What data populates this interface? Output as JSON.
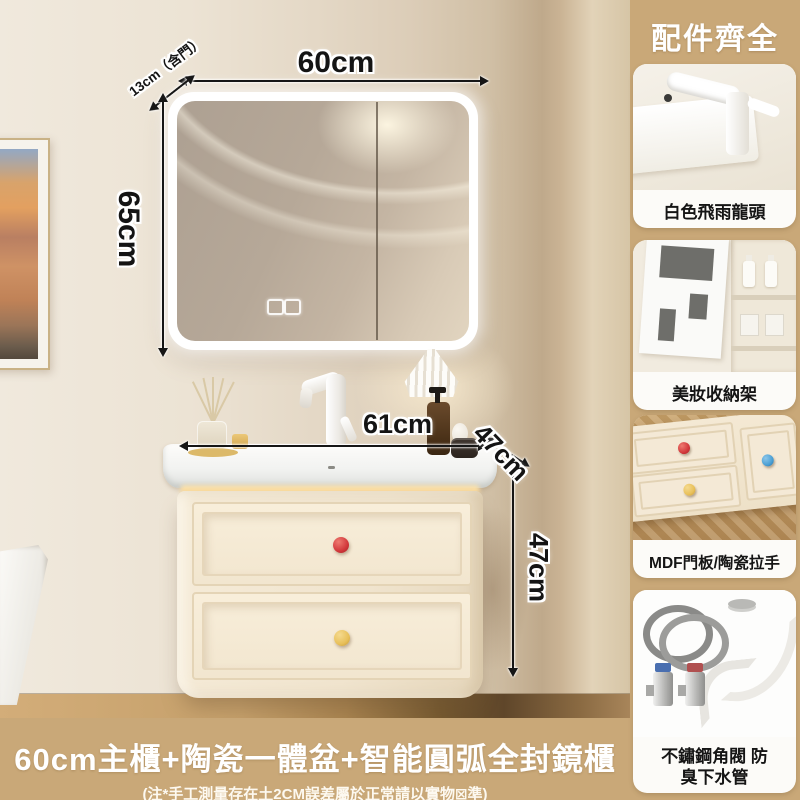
{
  "panel": {
    "title": "配件齊全",
    "cards": [
      {
        "name": "white-faucet",
        "caption": "白色飛雨龍頭"
      },
      {
        "name": "makeup-storage-rack",
        "caption": "美妝收納架"
      },
      {
        "name": "mdf-door-ceramic-handles",
        "caption": "MDF門板/陶瓷拉手"
      },
      {
        "name": "stainless-valve-drain",
        "caption": "不鏽鋼角閥 防臭下水管"
      }
    ]
  },
  "dims": {
    "mirror_width": "60cm",
    "mirror_depth": "13cm（含門）",
    "mirror_height": "65cm",
    "basin_width": "61cm",
    "cabinet_depth": "47cm",
    "cabinet_height": "47cm"
  },
  "banner": {
    "title": "60cm主櫃+陶瓷一體盆+智能圓弧全封鏡櫃",
    "note": "(注*手工測量存在土2CM誤差屬於正常請以實物⊠準)"
  },
  "colors": {
    "panel_bg": "#c9a878",
    "card_bg": "#fcfbf8",
    "banner_text": "#ffffff",
    "dimension_text": "#141414",
    "cabinet_cream": "#f3e8d6",
    "knob_red": "#d2383b",
    "knob_yellow": "#e8c05a",
    "knob_blue": "#4a9fd4",
    "led_strip": "#f7d28e",
    "wood_floor": "#c5a06b"
  }
}
